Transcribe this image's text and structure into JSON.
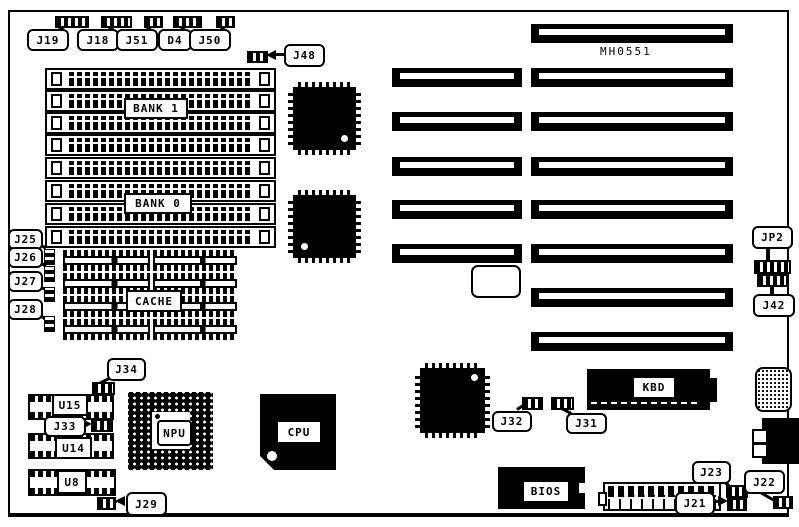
{
  "board": {
    "part_number": "MH0551"
  },
  "memory": {
    "bank1_label": "BANK 1",
    "bank0_label": "BANK 0",
    "cache_label": "CACHE"
  },
  "chips": {
    "npu": "NPU",
    "cpu": "CPU",
    "kbd": "KBD",
    "bios": "BIOS",
    "u15": "U15",
    "u14": "U14",
    "u8": "U8"
  },
  "jumpers": {
    "j19": "J19",
    "j18": "J18",
    "j51": "J51",
    "d4": "D4",
    "j50": "J50",
    "j48": "J48",
    "j25": "J25",
    "j26": "J26",
    "j27": "J27",
    "j28": "J28",
    "jp2": "JP2",
    "j42": "J42",
    "j34": "J34",
    "j33": "J33",
    "j29": "J29",
    "j32": "J32",
    "j31": "J31",
    "j23": "J23",
    "j22": "J22",
    "j21": "J21"
  }
}
